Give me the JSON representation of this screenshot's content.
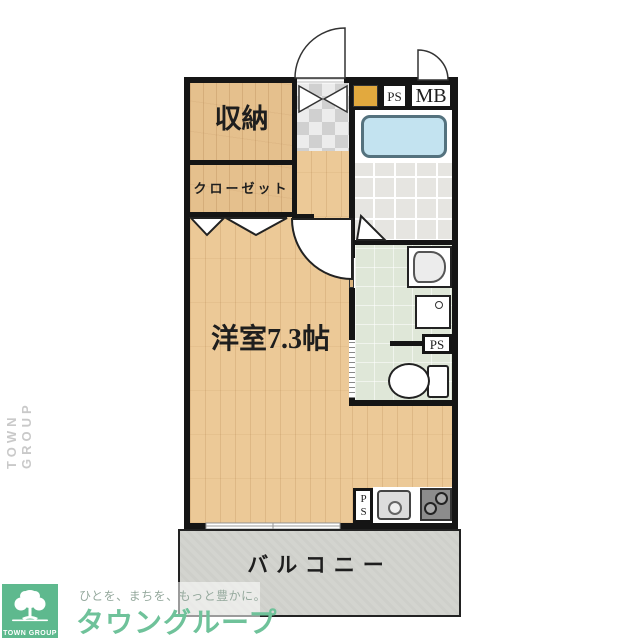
{
  "plan": {
    "storage": "収納",
    "closet": "クローゼット",
    "main_room": "洋室7.3帖",
    "balcony": "バルコニー",
    "ps_top": "PS",
    "mb": "MB",
    "ps_wash": "PS",
    "ps_kitchen": "PS"
  },
  "branding": {
    "tagline": "ひとを、まちを、もっと豊かに。",
    "company": "タウングループ",
    "logo_caption": "TOWN GROUP",
    "side_watermark": "TOWN GROUP"
  },
  "colors": {
    "brand_green": "#5eb98e",
    "wall_black": "#151515",
    "wood_floor": "#ecc997",
    "tub_blue": "#c3e3f0",
    "washroom_green": "#dfe7d8",
    "balcony_gray": "#d3d4cf",
    "shoe_cabinet_orange": "#e2a93e"
  }
}
